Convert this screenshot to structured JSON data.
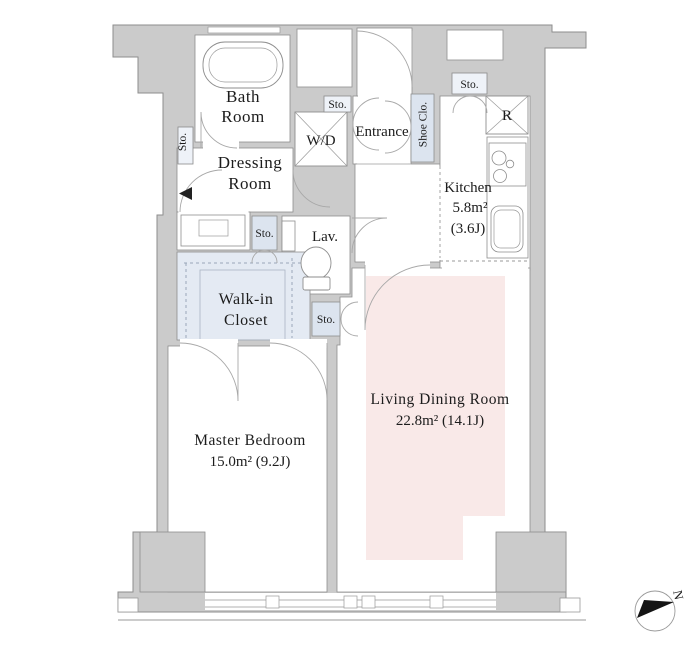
{
  "title": "Apartment floor plan 1LDK",
  "rooms": {
    "bath": {
      "line1": "Bath",
      "line2": "Room"
    },
    "dressing": {
      "line1": "Dressing",
      "line2": "Room"
    },
    "washer_dryer": {
      "label": "W/D"
    },
    "entrance": {
      "label": "Entrance"
    },
    "shoe_closet": {
      "label": "Shoe Clo."
    },
    "storage": {
      "label": "Sto."
    },
    "refrigerator": {
      "label": "R"
    },
    "kitchen": {
      "name": "Kitchen",
      "area_sqm": "5.8m²",
      "area_tatami": "(3.6J)"
    },
    "lavatory": {
      "label": "Lav."
    },
    "walk_in_closet": {
      "line1": "Walk-in",
      "line2": "Closet"
    },
    "master_bedroom": {
      "name": "Master Bedroom",
      "area": "15.0m²  (9.2J)"
    },
    "living_dining": {
      "name": "Living Dining Room",
      "area": "22.8m²  (14.1J)"
    }
  },
  "compass": {
    "label": "N"
  },
  "colors": {
    "wall": "#cbcbcb",
    "wall_line": "#8e8e8e",
    "storage": "#dce4ef",
    "closet": "#e4eaf3",
    "living": "#f9e9e8",
    "arc": "#a8a8a8"
  }
}
